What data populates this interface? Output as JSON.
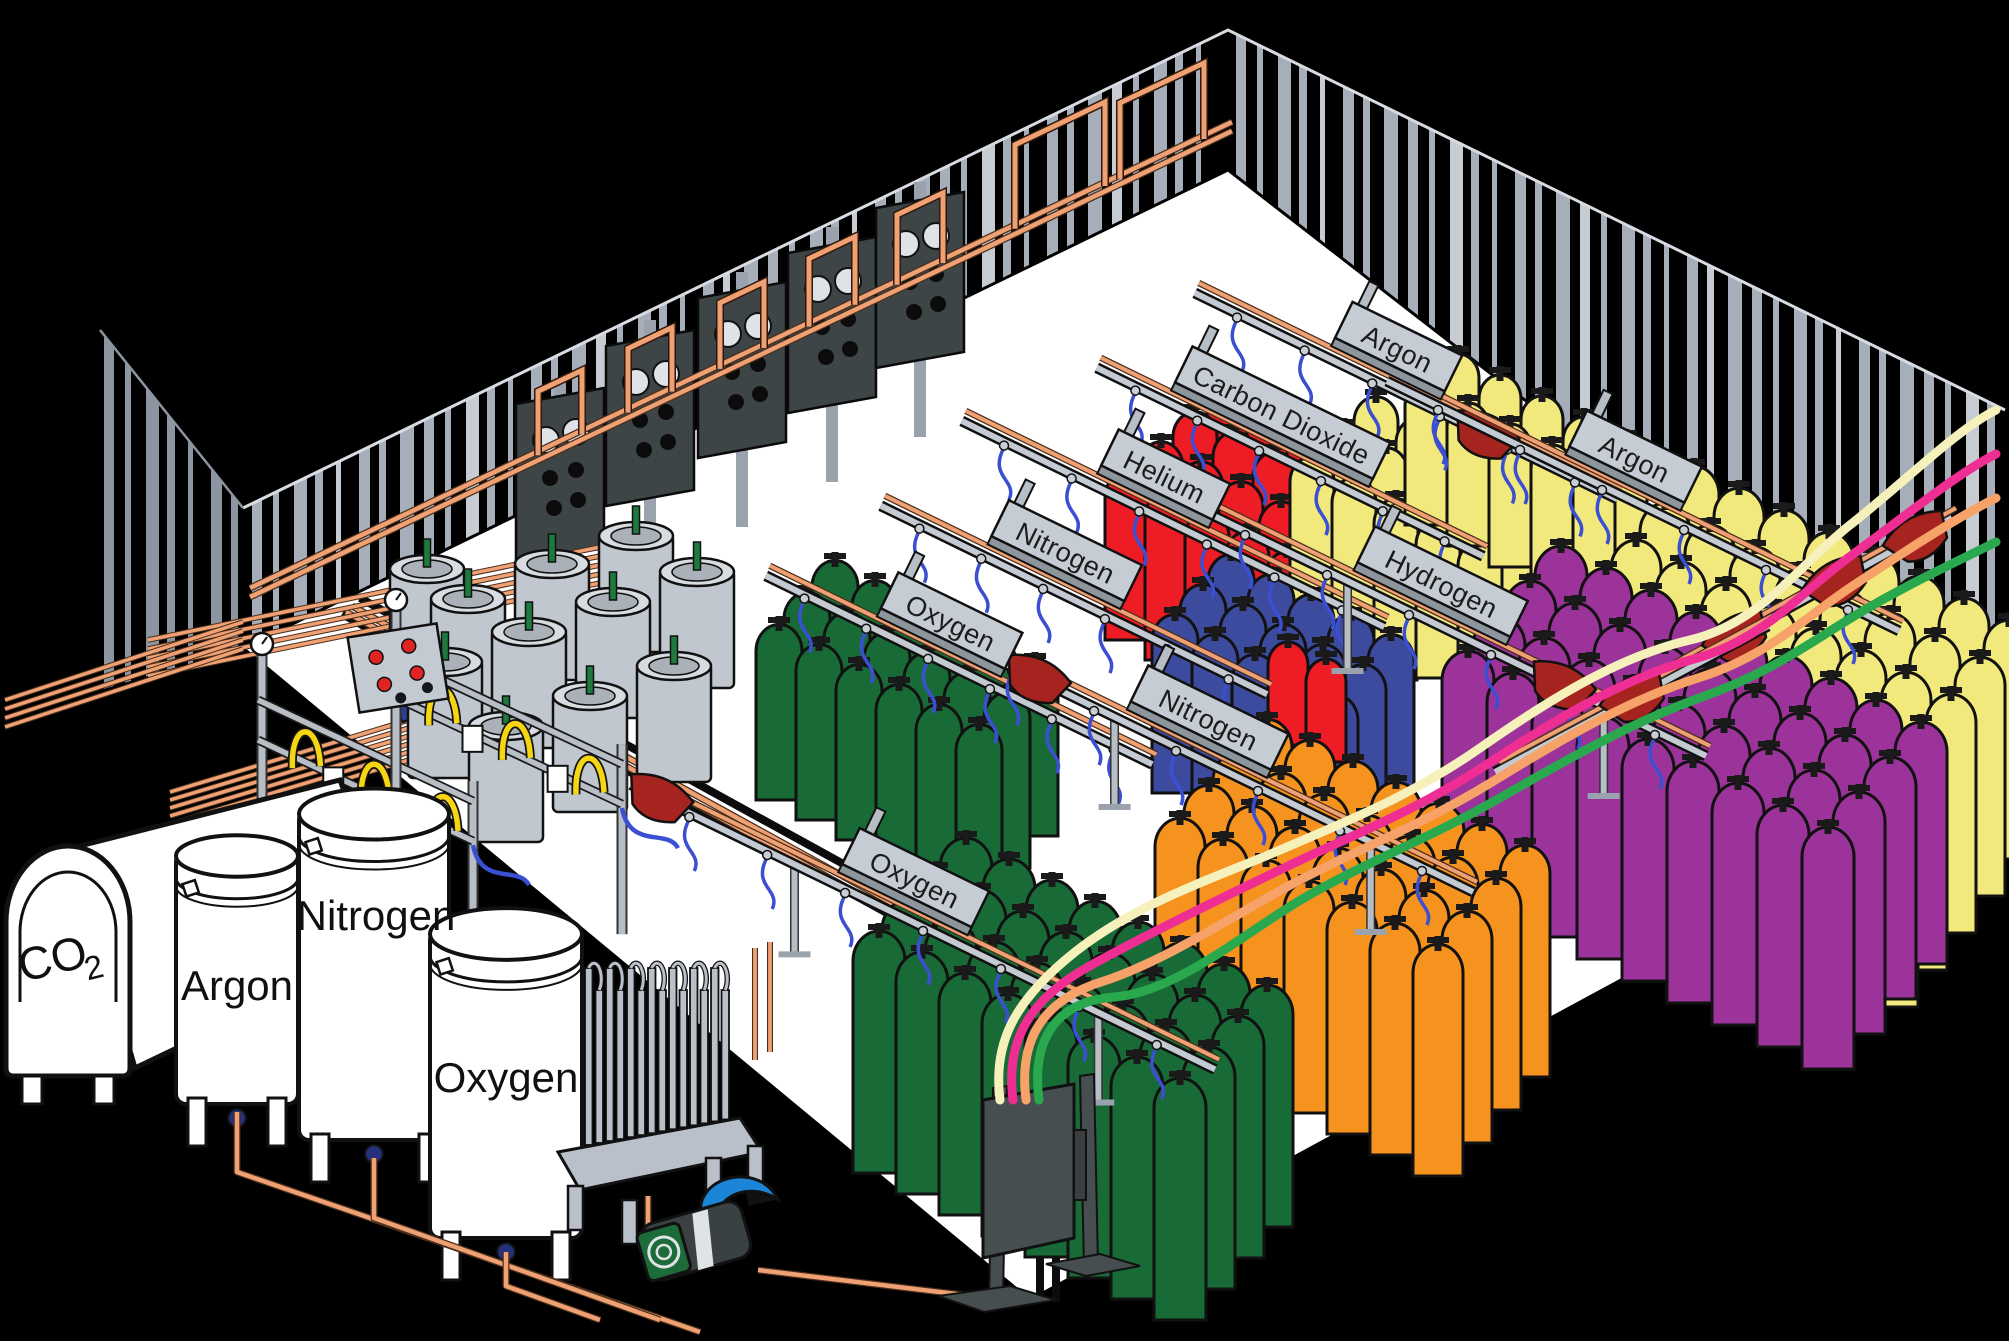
{
  "scene": {
    "title": "Industrial gas cylinder filling plant",
    "background": "#000000",
    "floor_color": "#ffffff",
    "wall_stripe_color": "#a6aeb9",
    "wall_stripe_light": "#c6ccd2",
    "outer_wall_stripe": "#8d95a0",
    "wall_edge_color": "#d8dce2"
  },
  "palette": {
    "copper": "#f0a173",
    "copper_edge": "#4a2e1c",
    "rail_gray": "#c3cad2",
    "rail_dark": "#101010",
    "post_gray": "#b7bec6",
    "panel_dark": "#3e4547",
    "panel_circle_light": "#dfe3e7",
    "saddle_red": "#a6241f",
    "hose_blue": "#3b4fd2",
    "hose_yellow": "#f6d513",
    "dewar_gray": "#c0c7ce",
    "dewar_rim": "#d8dce1",
    "dewar_inner": "#aab1b9",
    "valve_green": "#1d7a3c",
    "pump_blue": "#1b86d8",
    "pump_green": "#1d6b38",
    "pump_body": "#3a4143",
    "stand_dark": "#474e50",
    "tank_white": "#ffffff",
    "outline": "#111111",
    "red_button": "#e02424"
  },
  "storage_tanks": [
    {
      "id": "co2-tank",
      "label_main": "CO",
      "label_sub": "2"
    },
    {
      "id": "argon-tank",
      "label": "Argon"
    },
    {
      "id": "nitrogen-tank",
      "label": "Nitrogen"
    },
    {
      "id": "oxygen-tank",
      "label": "Oxygen"
    }
  ],
  "racks": [
    {
      "id": "oxygen-upper",
      "label": "Oxygen"
    },
    {
      "id": "nitrogen-upper",
      "label": "Nitrogen"
    },
    {
      "id": "helium",
      "label": "Helium"
    },
    {
      "id": "carbon-dioxide",
      "label": "Carbon Dioxide"
    },
    {
      "id": "argon-top",
      "label": "Argon"
    },
    {
      "id": "argon-right",
      "label": "Argon"
    },
    {
      "id": "hydrogen",
      "label": "Hydrogen"
    },
    {
      "id": "nitrogen-mid",
      "label": "Nitrogen"
    },
    {
      "id": "oxygen-lower",
      "label": "Oxygen"
    }
  ],
  "cylinder_groups": [
    {
      "gas": "Helium",
      "color": "#ee1c25",
      "cylinders": 24
    },
    {
      "gas": "Carbon Dioxide",
      "color": "#f2e97d",
      "cylinders": 15
    },
    {
      "gas": "Argon",
      "color": "#f2e97d",
      "cylinders": 10
    },
    {
      "gas": "Nitrogen",
      "color": "#3c4b9e",
      "cylinders": 15
    },
    {
      "gas": "Oxygen",
      "color": "#186b37",
      "cylinders": 18
    },
    {
      "gas": "Helium",
      "color": "#ee1c25",
      "cylinders": 2
    },
    {
      "gas": "Argon",
      "color": "#f2e97d",
      "cylinders": 40
    },
    {
      "gas": "Hydrogen",
      "color": "#9c339a",
      "cylinders": 36
    },
    {
      "gas": "Nitrogen",
      "color": "#f6921e",
      "cylinders": 28
    },
    {
      "gas": "Oxygen",
      "color": "#186b37",
      "cylinders": 32
    }
  ],
  "supply_lines": [
    {
      "name": "cream-line",
      "color": "#f6f0ba"
    },
    {
      "name": "pink-line",
      "color": "#ee2e92"
    },
    {
      "name": "orange-line",
      "color": "#f6a268"
    },
    {
      "name": "green-line",
      "color": "#2aa84e"
    }
  ]
}
